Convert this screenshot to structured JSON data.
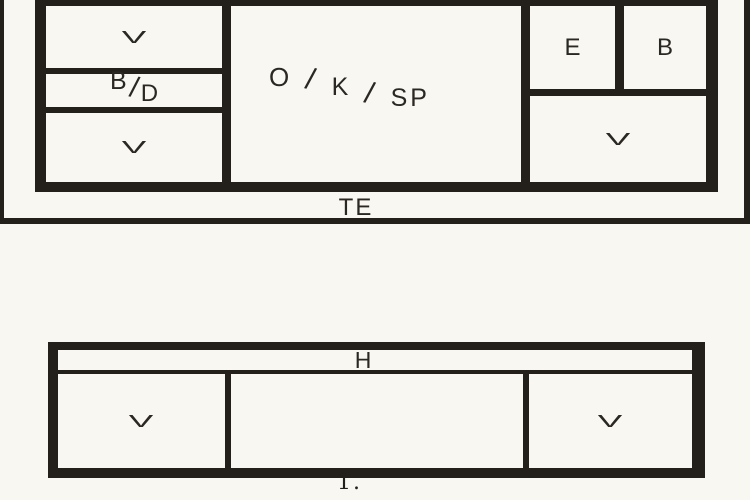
{
  "figure": {
    "background_color": "#f8f7f1",
    "line_color": "#231f1a",
    "text_color": "#2b2722"
  },
  "upper_plan": {
    "rooms": {
      "top_left": "V",
      "mid_left_parts": [
        "B",
        "/",
        "D"
      ],
      "bottom_left": "V",
      "center_parts": [
        "O",
        "/",
        "K",
        "/",
        "SP"
      ],
      "right_first": "E",
      "right_second": "B",
      "right_bottom": "V"
    },
    "terrace_label": "TE"
  },
  "lower_plan": {
    "hall_label": "H",
    "left_room": "V",
    "right_room": "V"
  },
  "caption": "1."
}
